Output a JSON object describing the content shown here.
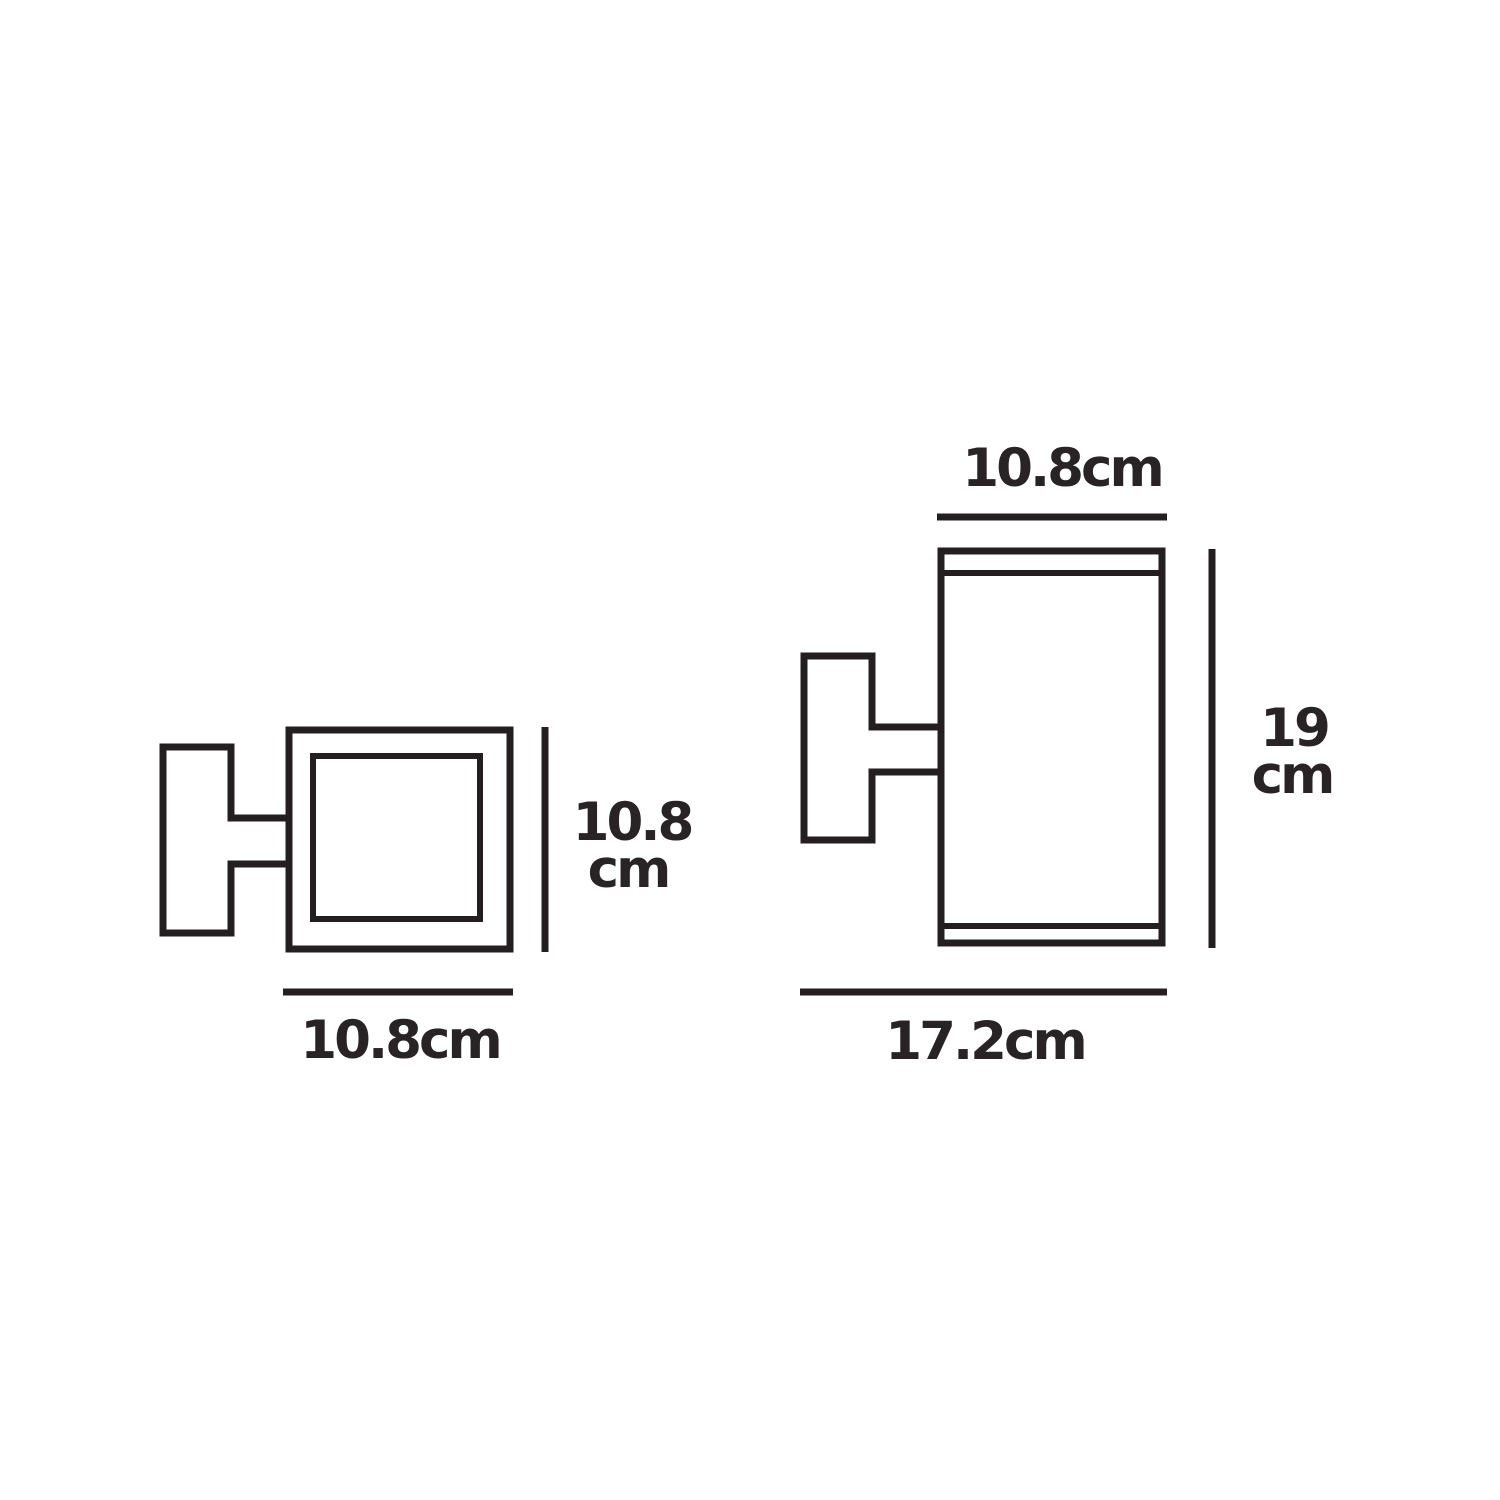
{
  "colors": {
    "line": "#231f20",
    "text": "#282425",
    "background": "#ffffff"
  },
  "front_view": {
    "height_value": "10.8",
    "height_unit": "cm",
    "width_label": "10.8cm"
  },
  "side_view": {
    "top_width_label": "10.8cm",
    "height_value": "19",
    "height_unit": "cm",
    "bottom_width_label": "17.2cm"
  }
}
